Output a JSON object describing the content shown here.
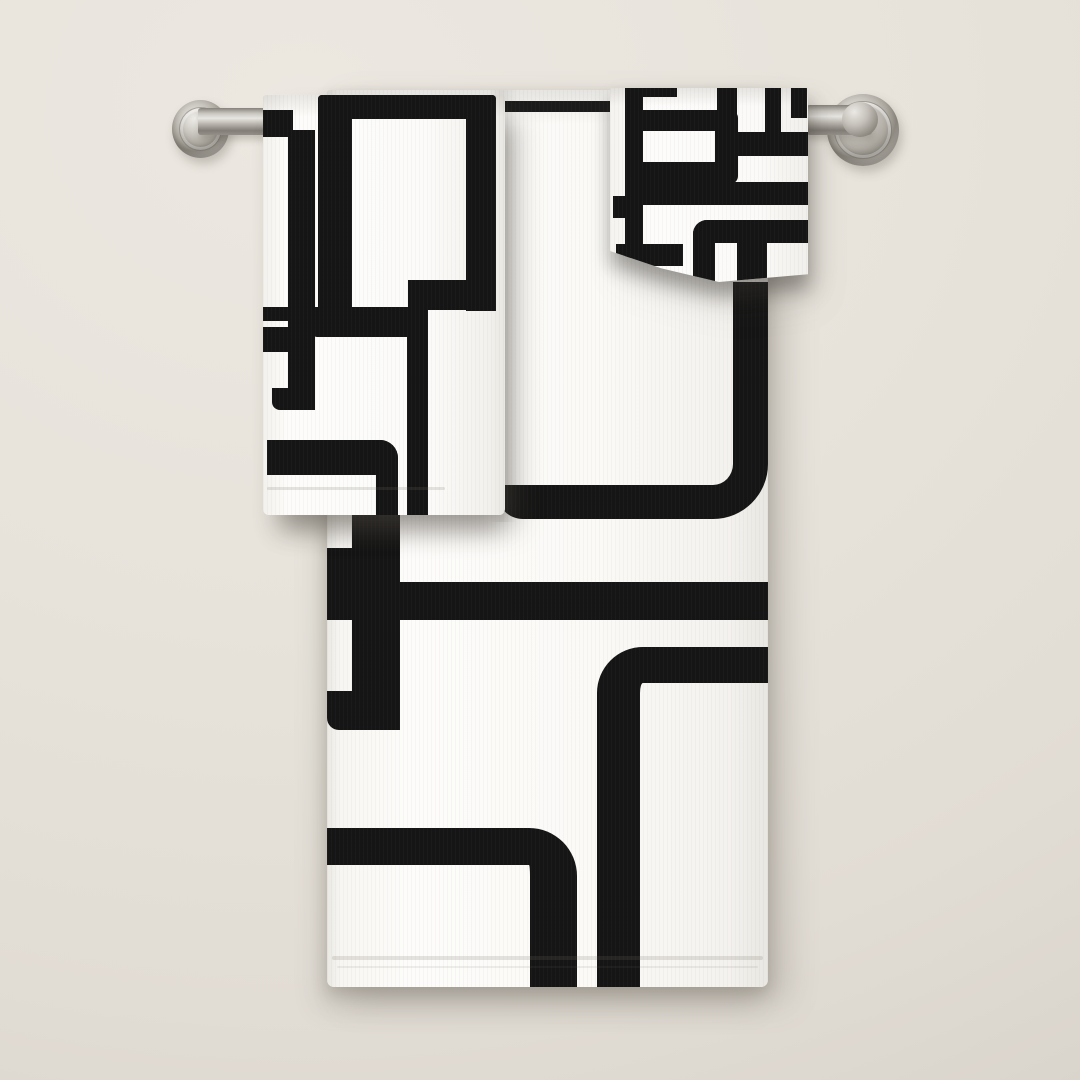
{
  "scene": {
    "label": "Black and white retro geometric pattern towel set hanging on a brushed nickel towel bar against an off-white wall",
    "wall": {
      "color": "#e6e2da"
    },
    "towel_bar": {
      "label": "brushed nickel wall-mounted towel bar",
      "metal_color": "#b3afa8",
      "left_post_label": "left mounting post",
      "right_post_label": "right mounting post"
    },
    "towels": {
      "bath_towel": {
        "label": "bath towel with black geometric rectangles pattern",
        "base_color": "#fbfaf7",
        "pattern_color": "#151515"
      },
      "hand_towel": {
        "label": "hand towel with black geometric rectangles pattern",
        "base_color": "#fcfbf9",
        "pattern_color": "#151515"
      },
      "washcloth": {
        "label": "washcloth with black geometric rectangles pattern",
        "base_color": "#fbfaf8",
        "pattern_color": "#151515"
      }
    }
  }
}
